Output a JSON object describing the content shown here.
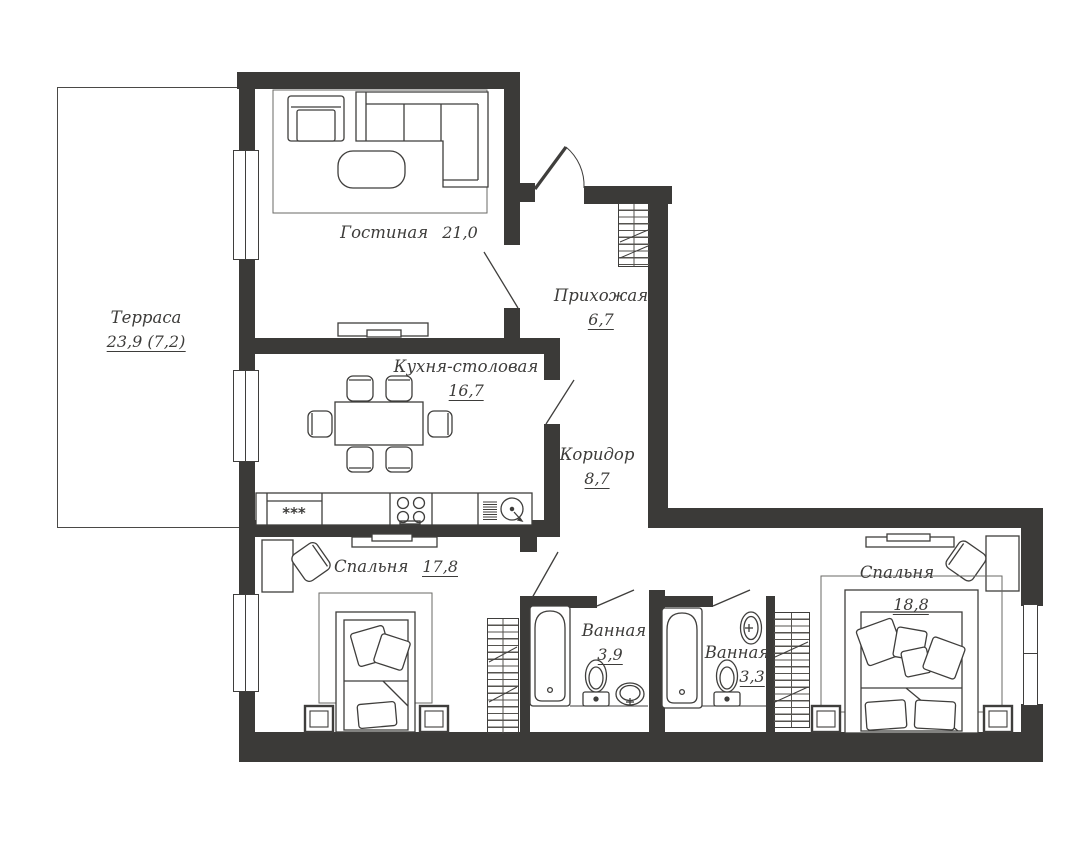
{
  "title": "Apartment floor plan",
  "colors": {
    "wall": "#3b3a38",
    "line": "#3f3e3c",
    "text": "#3d3c3a",
    "background": "#ffffff"
  },
  "rooms": [
    {
      "id": "terrace",
      "name": "Терраса",
      "area": "23,9 (7,2)"
    },
    {
      "id": "living",
      "name": "Гостиная",
      "area": "21,0"
    },
    {
      "id": "hallway",
      "name": "Прихожая",
      "area": "6,7"
    },
    {
      "id": "kitchen",
      "name": "Кухня-столовая",
      "area": "16,7"
    },
    {
      "id": "corridor",
      "name": "Коридор",
      "area": "8,7"
    },
    {
      "id": "bedroom1",
      "name": "Спальня",
      "area": "17,8"
    },
    {
      "id": "bath1",
      "name": "Ванная",
      "area": "3,9"
    },
    {
      "id": "bath2",
      "name": "Ванная",
      "area": "3,3"
    },
    {
      "id": "bedroom2",
      "name": "Спальня",
      "area": "18,8"
    }
  ],
  "kitchen": {
    "freezer_stars": "***"
  }
}
